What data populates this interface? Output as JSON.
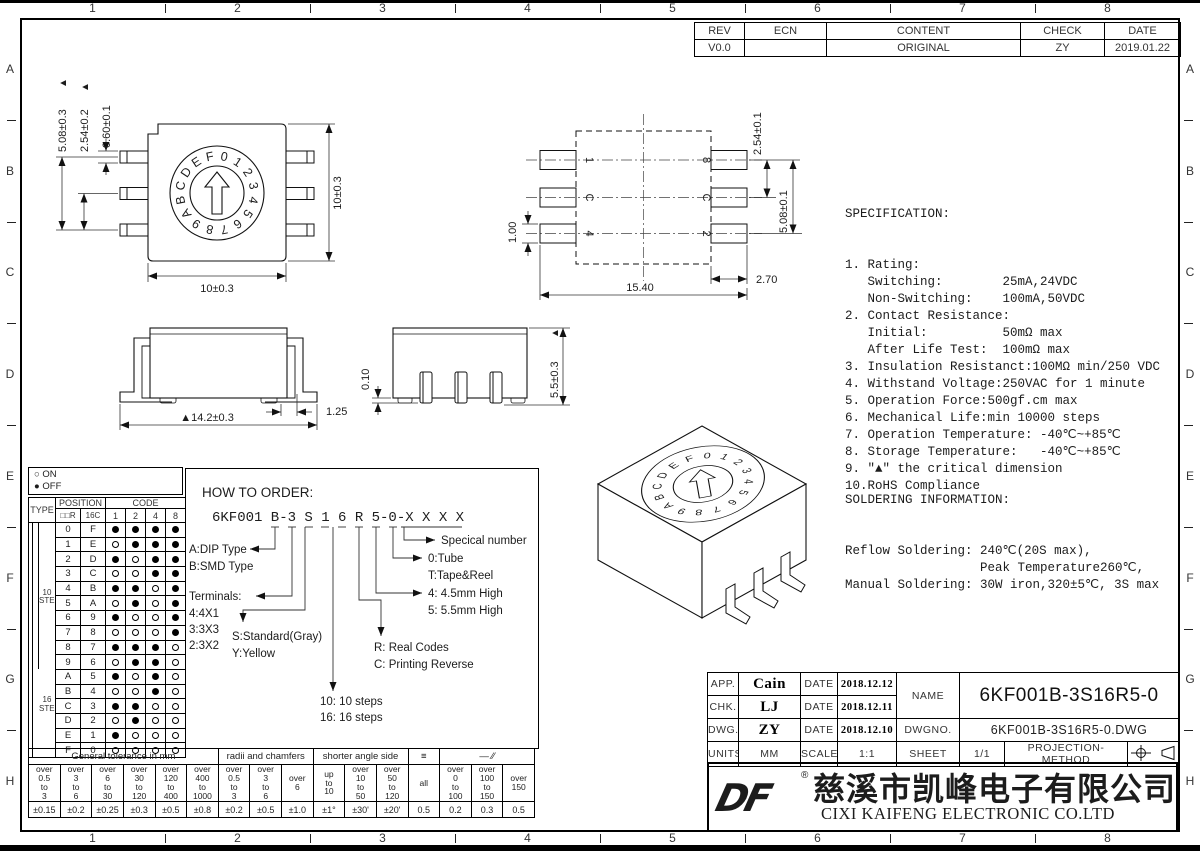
{
  "sheet": {
    "zones_h": [
      "1",
      "2",
      "3",
      "4",
      "5",
      "6",
      "7",
      "8"
    ],
    "zones_v": [
      "A",
      "B",
      "C",
      "D",
      "E",
      "F",
      "G",
      "H"
    ],
    "critical_mark": "▲"
  },
  "revision_table": {
    "headers": [
      "REV",
      "ECN",
      "CONTENT",
      "CHECK",
      "DATE"
    ],
    "row": [
      "V0.0",
      "",
      "ORIGINAL",
      "ZY",
      "2019.01.22"
    ]
  },
  "views": {
    "top": {
      "dial_chars": "0123456789ABCDEF",
      "dim_lead_span": "5.08±0.3",
      "dim_lead_pitch": "2.54±0.2",
      "dim_lead_width": "0.60±0.1",
      "dim_body_width": "10±0.3",
      "dim_body_height": "10±0.3"
    },
    "footprint": {
      "pins_left": [
        "1",
        "C",
        "4"
      ],
      "pins_right": [
        "8",
        "C",
        "2"
      ],
      "dim_pad_height": "1.00",
      "dim_pitch": "2.54±0.1",
      "dim_span": "5.08±0.1",
      "dim_pad_width": "2.70",
      "dim_total_width": "15.40"
    },
    "front": {
      "dim_foot": "1.25",
      "dim_overall": "▲14.2±0.3"
    },
    "side": {
      "dim_standoff": "0.10",
      "dim_height": "5.5±0.3"
    }
  },
  "spec": {
    "title": "SPECIFICATION:",
    "lines": [
      "1. Rating:",
      "   Switching:        25mA,24VDC",
      "   Non-Switching:    100mA,50VDC",
      "2. Contact Resistance:",
      "   Initial:          50mΩ max",
      "   After Life Test:  100mΩ max",
      "3. Insulation Resistanct:100MΩ min/250 VDC",
      "4. Withstand Voltage:250VAC for 1 minute",
      "5. Operation Force:500gf.cm max",
      "6. Mechanical Life:min 10000 steps",
      "7. Operation Temperature: -40℃~+85℃",
      "8. Storage Temperature:   -40℃~+85℃",
      "9. \"▲\" the critical dimension",
      "10.RoHS Compliance"
    ]
  },
  "soldering": {
    "title": "SOLDERING INFORMATION:",
    "lines": [
      "Reflow Soldering: 240℃(20S max),",
      "                  Peak Temperature260℃,",
      "Manual Soldering: 30W iron,320±5℃, 3S max"
    ]
  },
  "order": {
    "title": "HOW TO ORDER:",
    "code": "6KF001 B-3 S 1 6 R 5-0-X X X X",
    "labels": {
      "dip_a": "A:DIP Type",
      "dip_b": "B:SMD Type",
      "terminals": "Terminals:",
      "t4": "4:4X1",
      "t3": "3:3X3",
      "t2": "2:3X2",
      "std": "S:Standard(Gray)",
      "yellow": "Y:Yellow",
      "steps10": "10: 10 steps",
      "steps16": "16: 16 steps",
      "real": "R: Real Codes",
      "reverse": "C: Printing Reverse",
      "h4": "4: 4.5mm High",
      "h5": "5: 5.5mm High",
      "tube": "0:Tube",
      "tape": "T:Tape&Reel",
      "special": "Specical number"
    }
  },
  "code_table": {
    "legend": [
      {
        "symbol": "○",
        "label": "ON"
      },
      {
        "symbol": "●",
        "label": "OFF"
      }
    ],
    "header_type": "TYPE",
    "header_position": "POSITION",
    "header_code": "CODE",
    "position_sub": [
      "□□R",
      "16C"
    ],
    "code_sub": [
      "1",
      "2",
      "4",
      "8"
    ],
    "type_groups": [
      "10 STEP",
      "16 STEP"
    ],
    "rows": [
      {
        "pos": "0",
        "hex": "F",
        "dots": [
          1,
          1,
          1,
          1
        ]
      },
      {
        "pos": "1",
        "hex": "E",
        "dots": [
          0,
          1,
          1,
          1
        ]
      },
      {
        "pos": "2",
        "hex": "D",
        "dots": [
          1,
          0,
          1,
          1
        ]
      },
      {
        "pos": "3",
        "hex": "C",
        "dots": [
          0,
          0,
          1,
          1
        ]
      },
      {
        "pos": "4",
        "hex": "B",
        "dots": [
          1,
          1,
          0,
          1
        ]
      },
      {
        "pos": "5",
        "hex": "A",
        "dots": [
          0,
          1,
          0,
          1
        ]
      },
      {
        "pos": "6",
        "hex": "9",
        "dots": [
          1,
          0,
          0,
          1
        ]
      },
      {
        "pos": "7",
        "hex": "8",
        "dots": [
          0,
          0,
          0,
          1
        ]
      },
      {
        "pos": "8",
        "hex": "7",
        "dots": [
          1,
          1,
          1,
          0
        ]
      },
      {
        "pos": "9",
        "hex": "6",
        "dots": [
          0,
          1,
          1,
          0
        ]
      },
      {
        "pos": "A",
        "hex": "5",
        "dots": [
          1,
          0,
          1,
          0
        ]
      },
      {
        "pos": "B",
        "hex": "4",
        "dots": [
          0,
          0,
          1,
          0
        ]
      },
      {
        "pos": "C",
        "hex": "3",
        "dots": [
          1,
          1,
          0,
          0
        ]
      },
      {
        "pos": "D",
        "hex": "2",
        "dots": [
          0,
          1,
          0,
          0
        ]
      },
      {
        "pos": "E",
        "hex": "1",
        "dots": [
          1,
          0,
          0,
          0
        ]
      },
      {
        "pos": "F",
        "hex": "0",
        "dots": [
          0,
          0,
          0,
          0
        ]
      }
    ]
  },
  "tolerance_table": {
    "groups": [
      {
        "label": "General tolerance in mm",
        "span": 6
      },
      {
        "label": "radii and chamfers",
        "span": 3
      },
      {
        "label": "shorter angle side",
        "span": 3
      },
      {
        "label": "≡",
        "span": 1
      },
      {
        "label": "—  ∕∕",
        "span": 3
      }
    ],
    "ranges": [
      "over\n0.5\nto\n3",
      "over\n3\nto\n6",
      "over\n6\nto\n30",
      "over\n30\nto\n120",
      "over\n120\nto\n400",
      "over\n400\nto\n1000",
      "over\n0.5\nto\n3",
      "over\n3\nto\n6",
      "over\n6",
      "up\nto\n10",
      "over\n10\nto\n50",
      "over\n50\nto\n120",
      "all",
      "over\n0\nto\n100",
      "over\n100\nto\n150",
      "over\n150"
    ],
    "values": [
      "±0.15",
      "±0.2",
      "±0.25",
      "±0.3",
      "±0.5",
      "±0.8",
      "±0.2",
      "±0.5",
      "±1.0",
      "±1°",
      "±30'",
      "±20'",
      "0.5",
      "0.2",
      "0.3",
      "0.5"
    ]
  },
  "title_block": {
    "rows": [
      {
        "k1": "APP.",
        "v1": "Cain",
        "k2": "DATE",
        "v2": "2018.12.12"
      },
      {
        "k1": "CHK.",
        "v1": "LJ",
        "k2": "DATE",
        "v2": "2018.12.11"
      },
      {
        "k1": "DWG.",
        "v1": "ZY",
        "k2": "DATE",
        "v2": "2018.12.10"
      },
      {
        "k1": "UNITS",
        "v1": "MM",
        "k2": "SCALE",
        "v2": "1:1"
      }
    ],
    "name_label": "NAME",
    "name": "6KF001B-3S16R5-0",
    "dwgno_label": "DWGNO.",
    "dwgno": "6KF001B-3S16R5-0.DWG",
    "sheet_label": "SHEET",
    "sheet": "1/1",
    "projection_label": "PROJECTION-METHOD"
  },
  "company": {
    "logo": "DF",
    "reg": "®",
    "name_cn": "慈溪市凯峰电子有限公司",
    "name_en": "CIXI KAIFENG ELECTRONIC CO.LTD"
  }
}
